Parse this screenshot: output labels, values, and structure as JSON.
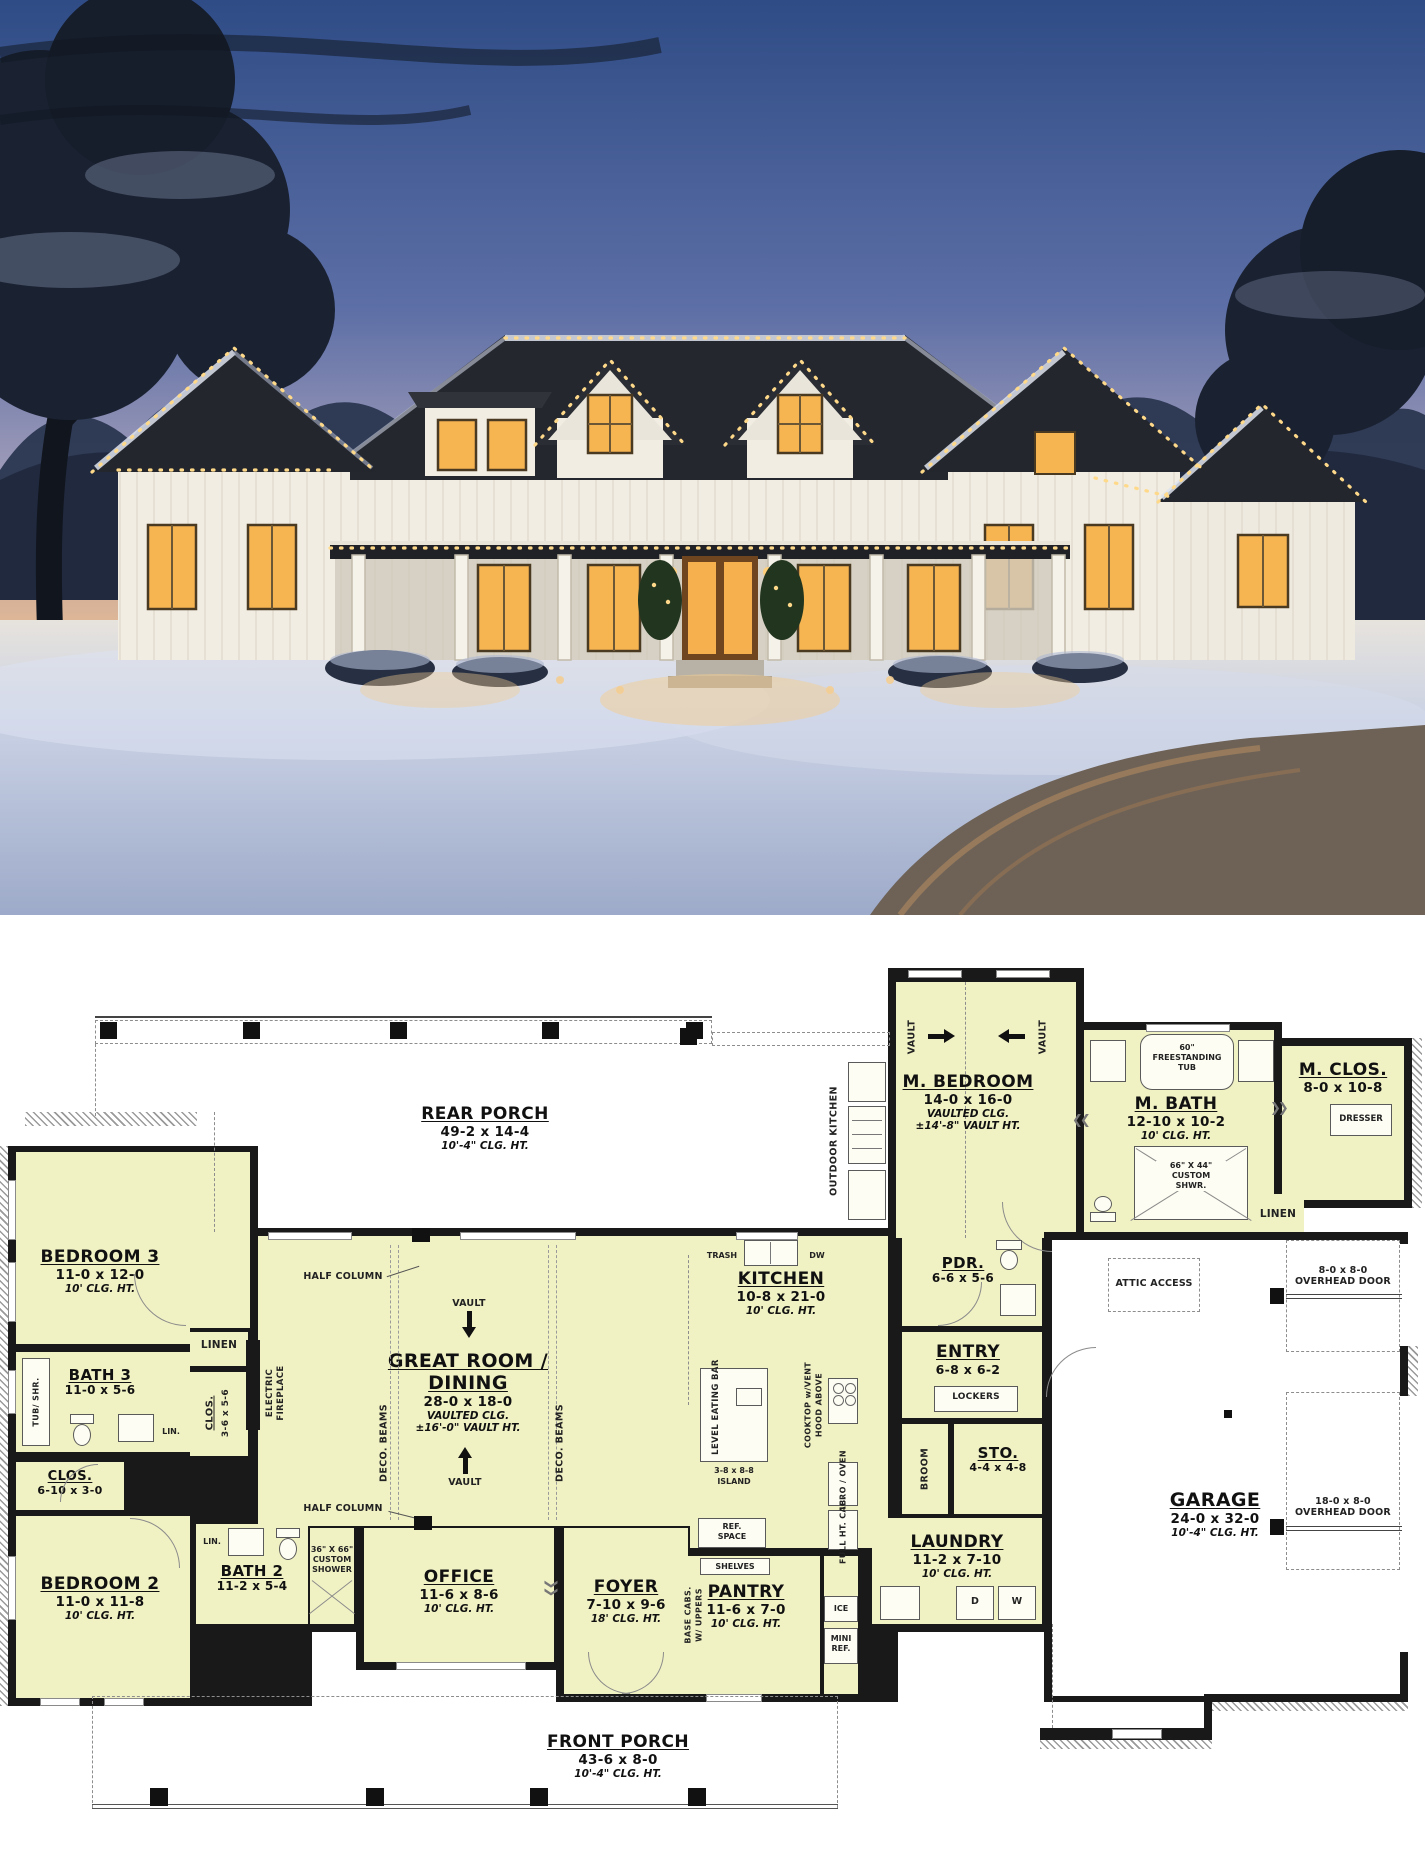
{
  "colors": {
    "plan_room_fill": "#f1f2c4",
    "plan_wall": "#191919",
    "sky_top": "#2f4c86",
    "sky_horizon": "#edc492",
    "window_glow": "#f7b552",
    "roof": "#24272d",
    "siding": "#f1ede2",
    "snow": "#c9d1e4"
  },
  "plan": {
    "rooms": {
      "rear_porch": {
        "name": "REAR PORCH",
        "dims": "49-2 x 14-4",
        "clg": "10'-4\" CLG. HT."
      },
      "m_bedroom": {
        "name": "M. BEDROOM",
        "dims": "14-0 x 16-0",
        "clg": "VAULTED CLG.",
        "vault": "±14'-8\" VAULT HT."
      },
      "m_bath": {
        "name": "M. BATH",
        "dims": "12-10 x 10-2",
        "clg": "10' CLG. HT."
      },
      "m_clos": {
        "name": "M. CLOS.",
        "dims": "8-0 x 10-8"
      },
      "bedroom3": {
        "name": "BEDROOM 3",
        "dims": "11-0 x 12-0",
        "clg": "10' CLG. HT."
      },
      "bath3": {
        "name": "BATH 3",
        "dims": "11-0 x 5-6"
      },
      "clos_bed3": {
        "name": "CLOS.",
        "dims": "3-6 x 5-6"
      },
      "clos_hall": {
        "name": "CLOS.",
        "dims": "6-10 x 3-0"
      },
      "bedroom2": {
        "name": "BEDROOM 2",
        "dims": "11-0 x 11-8",
        "clg": "10' CLG. HT."
      },
      "bath2": {
        "name": "BATH 2",
        "dims": "11-2 x 5-4"
      },
      "great_room": {
        "name": "GREAT ROOM /",
        "name2": "DINING",
        "dims": "28-0 x 18-0",
        "clg": "VAULTED CLG.",
        "vault": "±16'-0\" VAULT HT."
      },
      "kitchen": {
        "name": "KITCHEN",
        "dims": "10-8 x 21-0",
        "clg": "10' CLG. HT."
      },
      "pdr": {
        "name": "PDR.",
        "dims": "6-6 x 5-6"
      },
      "entry": {
        "name": "ENTRY",
        "dims": "6-8 x 6-2"
      },
      "sto": {
        "name": "STO.",
        "dims": "4-4 x 4-8"
      },
      "laundry": {
        "name": "LAUNDRY",
        "dims": "11-2 x 7-10",
        "clg": "10' CLG. HT."
      },
      "pantry": {
        "name": "PANTRY",
        "dims": "11-6 x 7-0",
        "clg": "10' CLG. HT."
      },
      "office": {
        "name": "OFFICE",
        "dims": "11-6 x 8-6",
        "clg": "10' CLG. HT."
      },
      "foyer": {
        "name": "FOYER",
        "dims": "7-10 x 9-6",
        "clg": "18' CLG. HT."
      },
      "garage": {
        "name": "GARAGE",
        "dims": "24-0 x 32-0",
        "clg": "10'-4\" CLG. HT."
      },
      "front_porch": {
        "name": "FRONT PORCH",
        "dims": "43-6 x 8-0",
        "clg": "10'-4\" CLG. HT."
      }
    },
    "ann": {
      "vault": "VAULT",
      "half_column": "HALF COLUMN",
      "deco_beams": "DECO. BEAMS",
      "elec1": "ELECTRIC",
      "elec2": "FIREPLACE",
      "linen": "LINEN",
      "lin": "LIN.",
      "tub_shr": "TUB/ SHR.",
      "tub1": "60\"",
      "tub2": "FREESTANDING",
      "tub3": "TUB",
      "mshwr1": "66\" X 44\"",
      "mshwr2": "CUSTOM",
      "mshwr3": "SHWR.",
      "shwr21": "36\" X 66\"",
      "shwr22": "CUSTOM",
      "shwr23": "SHOWER",
      "dresser": "DRESSER",
      "outdoor_kitchen": "OUTDOOR KITCHEN",
      "trash": "TRASH",
      "dw": "DW",
      "island_dims": "3-8 x 8-8",
      "island": "ISLAND",
      "leb": "LEVEL EATING BAR",
      "cook1": "COOKTOP w/VENT",
      "cook2": "HOOD ABOVE",
      "micro": "MICRO / OVEN",
      "fullht": "FULL HT. CAB.",
      "ref1": "REF.",
      "ref2": "SPACE",
      "shelves": "SHELVES",
      "base1": "BASE CABS.",
      "base2": "W/ UPPERS",
      "ice": "ICE",
      "mini1": "MINI",
      "mini2": "REF.",
      "lockers": "LOCKERS",
      "broom": "BROOM",
      "attic": "ATTIC ACCESS",
      "d8": "8-0 x 8-0",
      "d18": "18-0 x 8-0",
      "ohd": "OVERHEAD DOOR",
      "d": "D",
      "w": "W"
    }
  }
}
